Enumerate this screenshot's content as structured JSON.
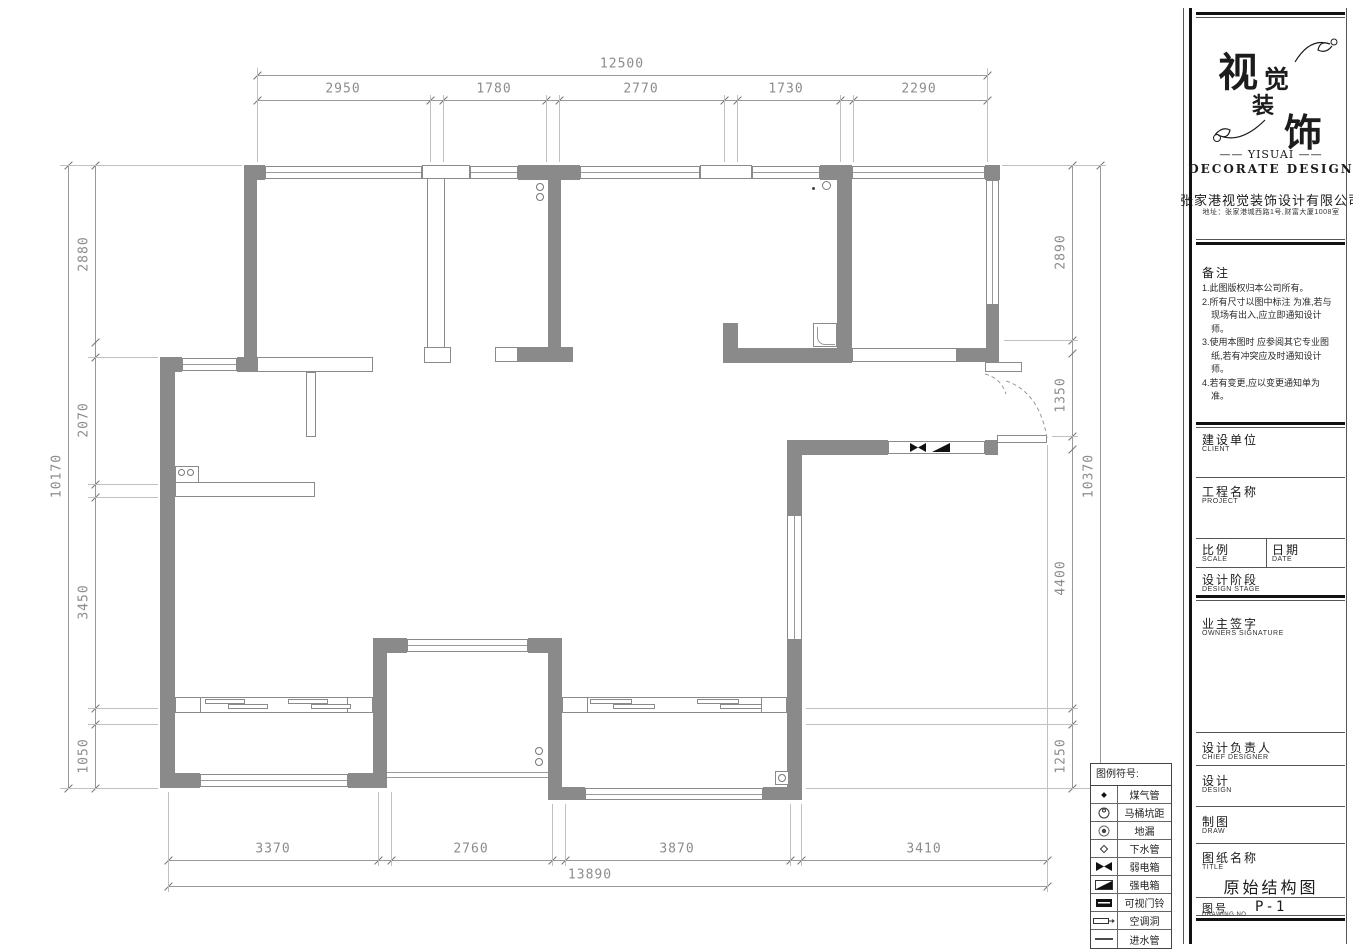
{
  "drawing": {
    "title": "原始结构图",
    "number": "P-1"
  },
  "dims": {
    "top_total": "12500",
    "top_segments": [
      "2950",
      "1780",
      "2770",
      "1730",
      "2290"
    ],
    "left_total": "10170",
    "left_segments": [
      "2880",
      "2070",
      "3450",
      "1050"
    ],
    "right_total": "10370",
    "right_segments": [
      "2890",
      "1350",
      "4400",
      "1250"
    ],
    "bottom_total": "13890",
    "bottom_segments": [
      "3370",
      "2760",
      "3870",
      "3410"
    ]
  },
  "legend": {
    "title": "图例符号:",
    "items": [
      {
        "symbol": "gas-pipe",
        "label": "煤气管"
      },
      {
        "symbol": "toilet-distance",
        "label": "马桶坑距"
      },
      {
        "symbol": "floor-drain",
        "label": "地漏"
      },
      {
        "symbol": "drain-pipe",
        "label": "下水管"
      },
      {
        "symbol": "weak-current-box",
        "label": "弱电箱"
      },
      {
        "symbol": "strong-current-box",
        "label": "强电箱"
      },
      {
        "symbol": "video-doorbell",
        "label": "可视门铃"
      },
      {
        "symbol": "ac-hole",
        "label": "空调洞"
      },
      {
        "symbol": "water-inlet",
        "label": "进水管"
      }
    ]
  },
  "title_block": {
    "logo_chars": {
      "c1": "视",
      "c2": "觉",
      "c3": "装",
      "c4": "饰"
    },
    "logo_en1": "—— YISUAI ——",
    "logo_en2": "DECORATE DESIGN",
    "company": "张家港视觉装饰设计有限公司",
    "address": "地址：张家港城西路1号,财富大厦1008室",
    "notes_title": "备注",
    "notes": [
      "1.此图版权归本公司所有。",
      "2.所有尺寸以图中标注 为准,若与现场有出入,应立即通知设计师。",
      "3.使用本图时 应参阅其它专业图纸,若有冲突应及时通知设计师。",
      "4.若有变更,应以变更通知单为准。"
    ],
    "fields": [
      {
        "cn": "建设单位",
        "en": "CLIENT"
      },
      {
        "cn": "工程名称",
        "en": "PROJECT"
      },
      {
        "cn": "比例",
        "en": "SCALE"
      },
      {
        "cn": "日期",
        "en": "DATE"
      },
      {
        "cn": "设计阶段",
        "en": "DESIGN STAGE"
      },
      {
        "cn": "业主签字",
        "en": "OWNERS SIGNATURE"
      },
      {
        "cn": "设计负责人",
        "en": "CHIEF DESIGNER"
      },
      {
        "cn": "设计",
        "en": "DESIGN"
      },
      {
        "cn": "制图",
        "en": "DRAW"
      },
      {
        "cn": "图纸名称",
        "en": "TITLE"
      },
      {
        "cn": "图号",
        "en": "DRAWING NO"
      }
    ]
  },
  "colors": {
    "wall": "#8a8a8a",
    "dim_text": "#8c8c8c",
    "black": "#1a1a1a"
  }
}
